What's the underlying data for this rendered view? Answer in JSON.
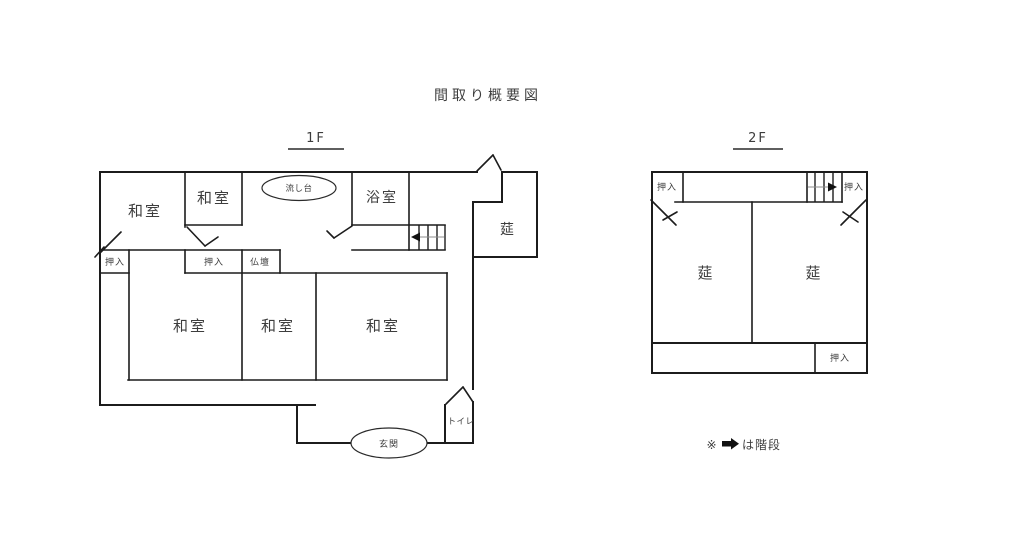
{
  "title": "間取り概要図",
  "floor1": {
    "label": "1F",
    "rooms": {
      "washitsu_top_left": "和室",
      "washitsu_top_small": "和室",
      "sink": "流し台",
      "bathroom": "浴室",
      "mushiro": "莚",
      "oshiire_left": "押入",
      "oshiire_middle": "押入",
      "butsudan": "仏壇",
      "washitsu_bottom_left": "和室",
      "washitsu_bottom_middle": "和室",
      "washitsu_bottom_right": "和室",
      "toilet": "トイレ",
      "entrance": "玄関"
    }
  },
  "floor2": {
    "label": "2F",
    "rooms": {
      "oshiire_top_left": "押入",
      "oshiire_top_right": "押入",
      "mushiro_left": "莚",
      "mushiro_right": "莚",
      "oshiire_bottom_right": "押入"
    }
  },
  "legend": {
    "prefix": "※",
    "arrow": "➡",
    "suffix": "は階段"
  },
  "colors": {
    "line": "#1c1c1c",
    "text": "#3d3d3d",
    "stair_guide": "#8d8d8d",
    "background": "#ffffff"
  }
}
